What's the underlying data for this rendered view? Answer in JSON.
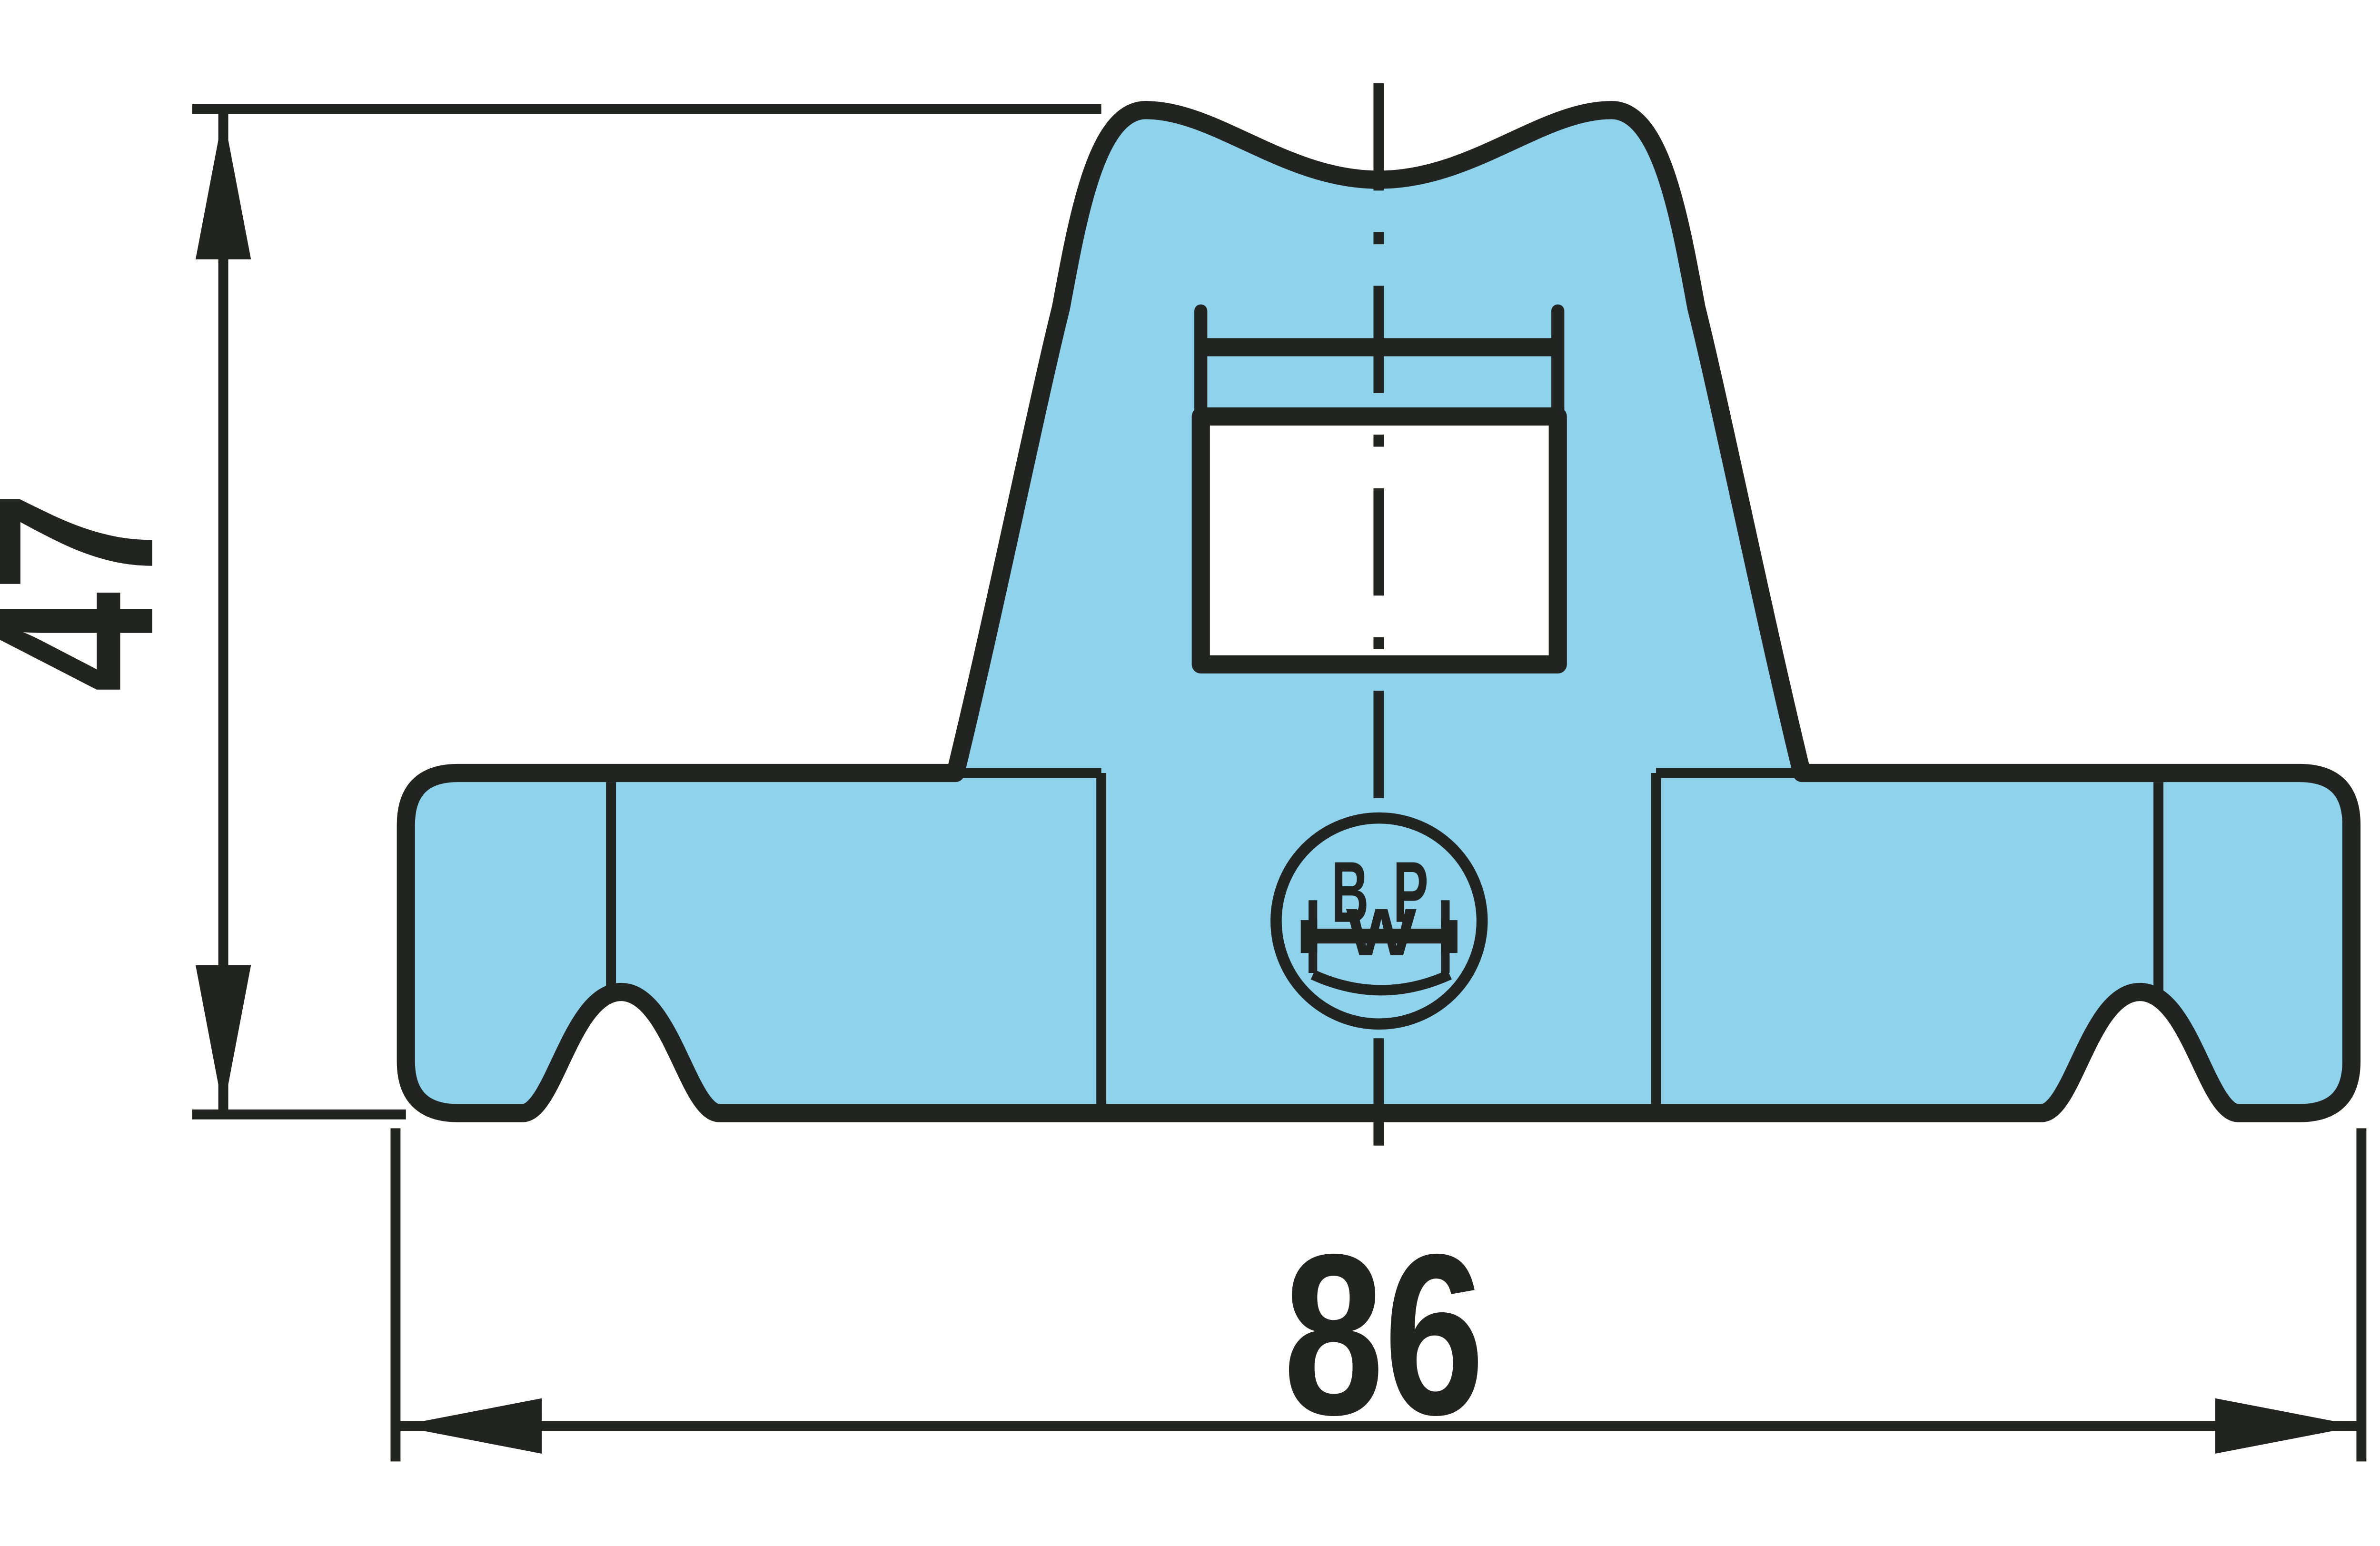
{
  "dimensions": {
    "height": {
      "value": "47"
    },
    "width": {
      "value": "86"
    }
  },
  "logo": {
    "name": "BPW",
    "letter_b": "B",
    "letter_p": "P",
    "letter_w": "W"
  },
  "colors": {
    "line": "#212420",
    "part_fill": "#8fd2ec",
    "hole_fill": "#ffffff",
    "background": "#ffffff"
  }
}
